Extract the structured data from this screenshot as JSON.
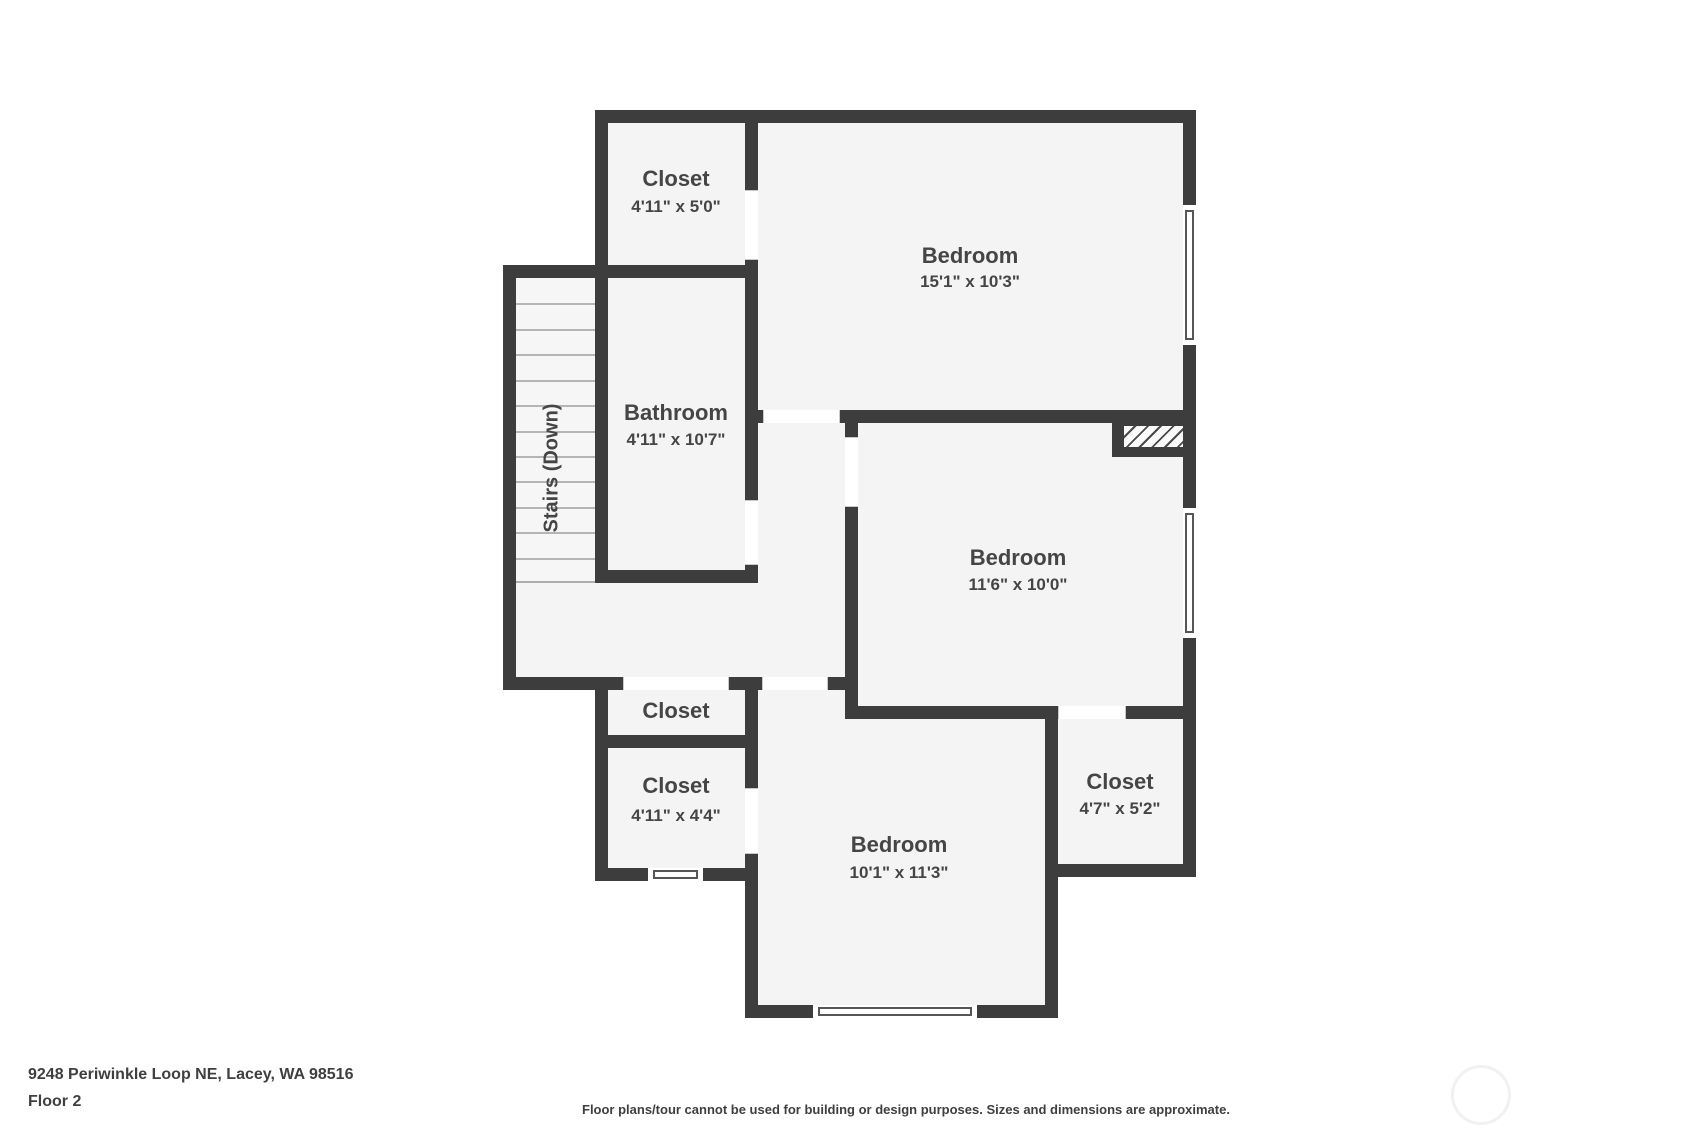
{
  "plan": {
    "rooms": [
      {
        "id": "closet-top-left",
        "name": "Closet",
        "dims": "4'11\" x 5'0\""
      },
      {
        "id": "bedroom-top",
        "name": "Bedroom",
        "dims": "15'1\" x 10'3\""
      },
      {
        "id": "bathroom",
        "name": "Bathroom",
        "dims": "4'11\" x 10'7\""
      },
      {
        "id": "bedroom-middle",
        "name": "Bedroom",
        "dims": "11'6\" x 10'0\""
      },
      {
        "id": "closet-hallway",
        "name": "Closet",
        "dims": ""
      },
      {
        "id": "closet-lower-left",
        "name": "Closet",
        "dims": "4'11\" x 4'4\""
      },
      {
        "id": "closet-bottom-right",
        "name": "Closet",
        "dims": "4'7\" x 5'2\""
      },
      {
        "id": "bedroom-bottom",
        "name": "Bedroom",
        "dims": "10'1\" x 11'3\""
      }
    ],
    "stairs_label": "Stairs (Down)"
  },
  "footer": {
    "address": "9248 Periwinkle Loop NE, Lacey, WA 98516",
    "floor_label": "Floor 2",
    "disclaimer": "Floor plans/tour cannot be used for building or design purposes. Sizes and dimensions are approximate."
  },
  "colors": {
    "wall": "#3d3d3d",
    "floor": "#f4f4f4",
    "text": "#454545"
  }
}
